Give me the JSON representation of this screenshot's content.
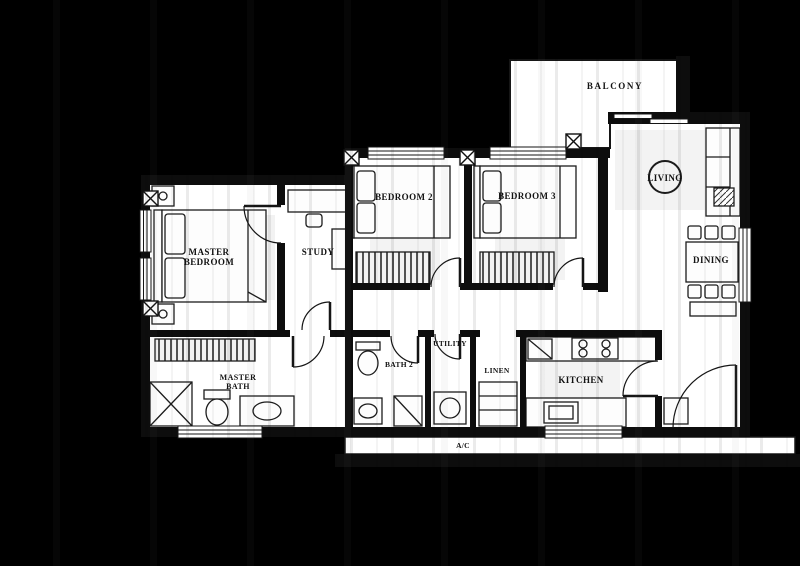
{
  "colors": {
    "background": "#000000",
    "paper": "#ffffff",
    "ink": "#141414"
  },
  "floor_plan": {
    "rooms": [
      {
        "key": "master_bedroom",
        "label": "MASTER\nBEDROOM"
      },
      {
        "key": "study",
        "label": "STUDY"
      },
      {
        "key": "bedroom_2",
        "label": "BEDROOM 2"
      },
      {
        "key": "bedroom_3",
        "label": "BEDROOM 3"
      },
      {
        "key": "balcony",
        "label": "BALCONY"
      },
      {
        "key": "living",
        "label": "LIVING"
      },
      {
        "key": "dining",
        "label": "DINING"
      },
      {
        "key": "master_bath",
        "label": "MASTER\nBATH"
      },
      {
        "key": "bath_2",
        "label": "BATH 2"
      },
      {
        "key": "utility",
        "label": "UTILITY"
      },
      {
        "key": "linen",
        "label": "LINEN"
      },
      {
        "key": "kitchen",
        "label": "KITCHEN"
      }
    ],
    "annotations": {
      "ac_ledge": "A/C"
    }
  }
}
